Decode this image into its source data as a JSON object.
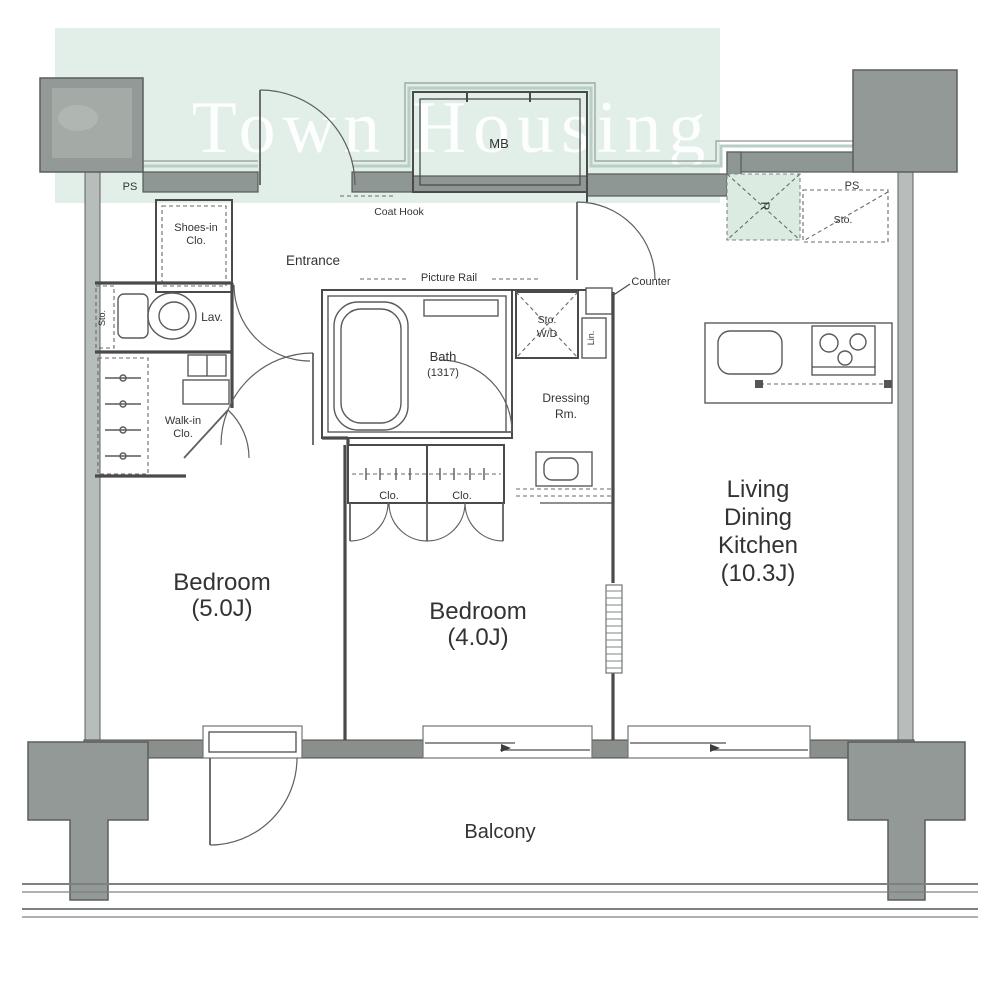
{
  "watermark": {
    "text": "Town Housing"
  },
  "labels": {
    "ps_left": "PS",
    "mb": "MB",
    "fridge": "R",
    "ps_right": "PS",
    "sto_top_right": "Sto.",
    "shoes_line1": "Shoes-in",
    "shoes_line2": "Clo.",
    "entrance": "Entrance",
    "coat_hook": "Coat Hook",
    "picture_rail": "Picture Rail",
    "counter": "Counter",
    "lav": "Lav.",
    "sto_lav": "Sto.",
    "walkin_line1": "Walk-in",
    "walkin_line2": "Clo.",
    "bath_line1": "Bath",
    "bath_line2": "(1317)",
    "sto_wd_line1": "Sto.",
    "sto_wd_line2": "W/D",
    "linen": "Lin.",
    "dressing_line1": "Dressing",
    "dressing_line2": "Rm.",
    "clo_left": "Clo.",
    "clo_right": "Clo.",
    "bedroom1_line1": "Bedroom",
    "bedroom1_line2": "(5.0J)",
    "bedroom2_line1": "Bedroom",
    "bedroom2_line2": "(4.0J)",
    "ldk_line1": "Living",
    "ldk_line2": "Dining",
    "ldk_line3": "Kitchen",
    "ldk_line4": "(10.3J)",
    "balcony": "Balcony"
  },
  "colors": {
    "watermark_band": "#e2eee8",
    "watermark_text": "#ffffff",
    "exterior_wall": "#8f9794",
    "bottom_wall": "#8a8f8c",
    "pillar": "#939996",
    "line": "#4a4a4a",
    "fridge_fill": "#dcebe2"
  }
}
